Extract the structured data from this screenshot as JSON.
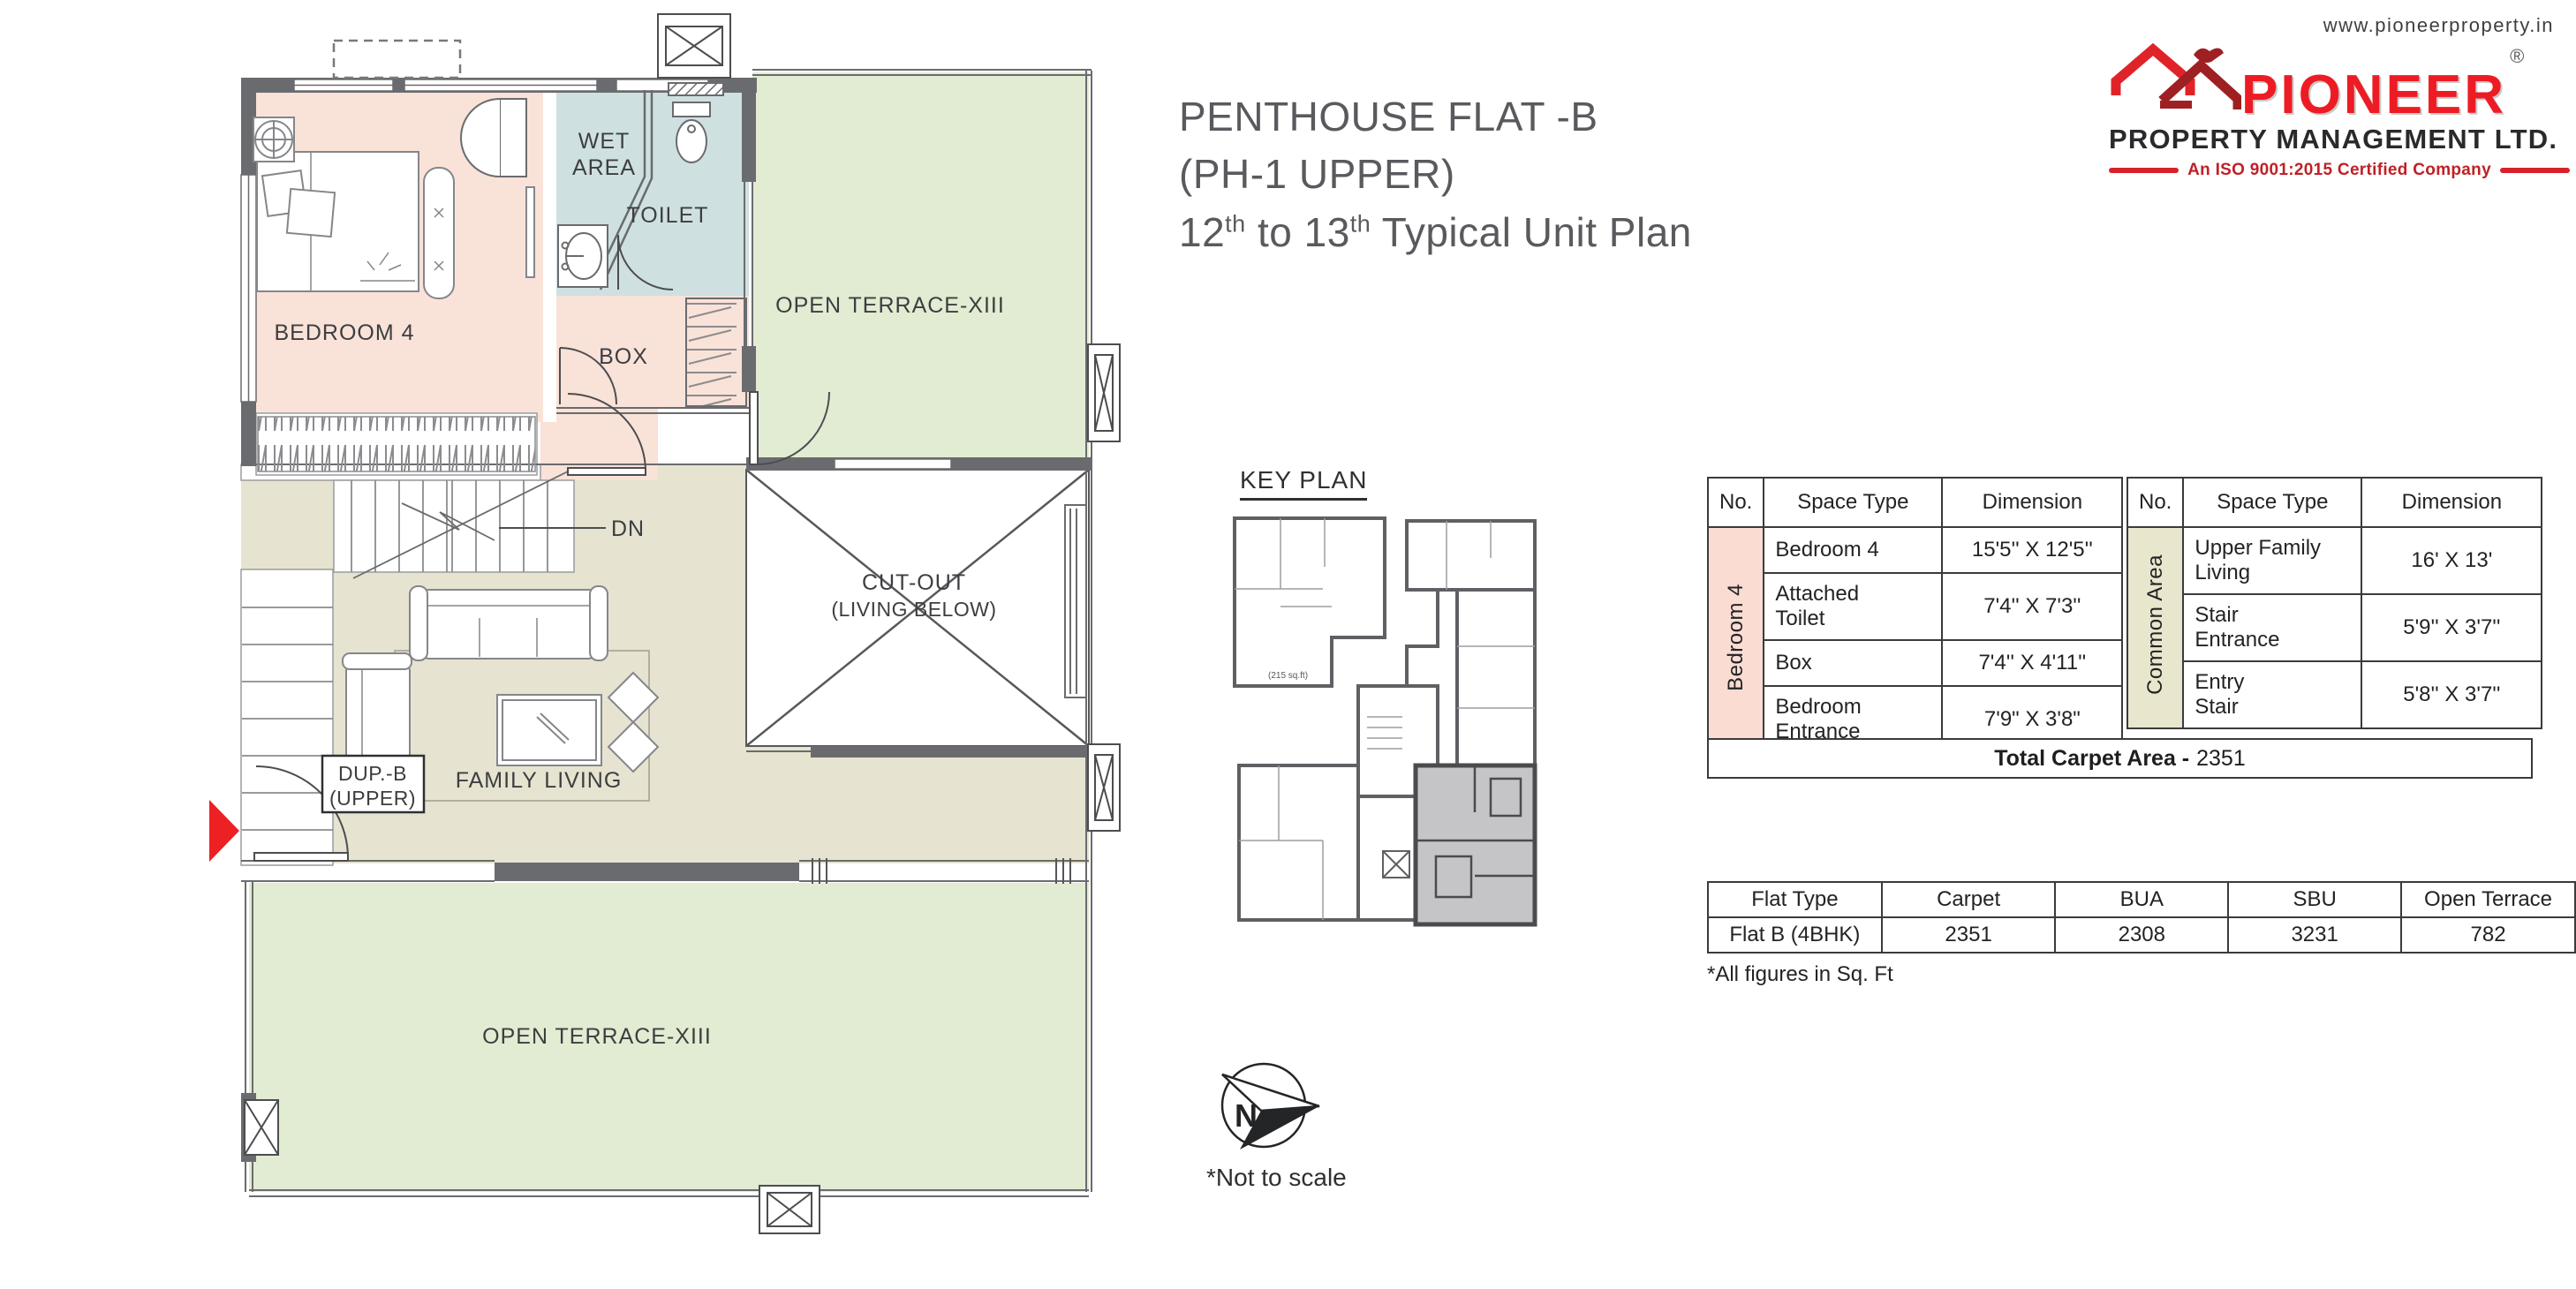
{
  "header": {
    "title_line1": "PENTHOUSE FLAT -B",
    "title_line2": "(PH-1 UPPER)",
    "title_line3_pre": "12",
    "title_line3_sup1": "th",
    "title_line3_mid": " to 13",
    "title_line3_sup2": "th",
    "title_line3_post": " Typical Unit Plan"
  },
  "logo": {
    "website": "www.pioneerproperty.in",
    "brand": "PIONEER",
    "registered": "®",
    "company": "PROPERTY MANAGEMENT LTD.",
    "tagline": "An ISO 9001:2015 Certified Company",
    "brand_color": "#ed1c24",
    "maroon_color": "#9e2023"
  },
  "floor_plan": {
    "labels": {
      "bedroom4": "BEDROOM 4",
      "wet_line1": "WET",
      "wet_line2": "AREA",
      "toilet": "TOILET",
      "box": "BOX",
      "open_terrace_top": "OPEN TERRACE-XIII",
      "cutout_line1": "CUT-OUT",
      "cutout_line2": "(LIVING BELOW)",
      "dn": "DN",
      "dup_line1": "DUP.-B",
      "dup_line2": "(UPPER)",
      "family_living": "FAMILY LIVING",
      "open_terrace_bottom": "OPEN TERRACE-XIII"
    },
    "colors": {
      "wall": "#6a6b6e",
      "bedroom_pink": "#f9e2d8",
      "wet_blue": "#cfe0e1",
      "terrace_green": "#e1ecd2",
      "family_beige": "#e6e3d0",
      "entry_arrow_red": "#ed2024"
    }
  },
  "key_plan": {
    "title": "KEY PLAN",
    "area_note": "(215 sq.ft)",
    "highlight_color": "#c5c5c7"
  },
  "compass": {
    "north_letter": "N",
    "note": "*Not to scale"
  },
  "dimension_tables": {
    "headers": {
      "no": "No.",
      "space": "Space Type",
      "dim": "Dimension"
    },
    "bedroom4": {
      "group": "Bedroom 4",
      "group_color": "#fbdcd3",
      "rows": [
        {
          "space": "Bedroom 4",
          "dim": "15'5'' X 12'5''"
        },
        {
          "space": "Attached\nToilet",
          "dim": "7'4'' X 7'3''"
        },
        {
          "space": "Box",
          "dim": "7'4'' X 4'11''"
        },
        {
          "space": "Bedroom\nEntrance",
          "dim": "7'9\" X 3'8\""
        }
      ]
    },
    "common": {
      "group": "Common Area",
      "group_color": "#e8e6cd",
      "rows": [
        {
          "space": "Upper Family\nLiving",
          "dim": "16' X 13'"
        },
        {
          "space": "Stair\nEntrance",
          "dim": "5'9'' X 3'7''"
        },
        {
          "space": "Entry\nStair",
          "dim": "5'8'' X 3'7''"
        }
      ]
    },
    "total_label": "Total Carpet Area -",
    "total_value": "2351"
  },
  "flat_table": {
    "headers": [
      "Flat Type",
      "Carpet",
      "BUA",
      "SBU",
      "Open Terrace"
    ],
    "row": [
      "Flat B (4BHK)",
      "2351",
      "2308",
      "3231",
      "782"
    ],
    "footnote": "*All figures in Sq. Ft"
  }
}
